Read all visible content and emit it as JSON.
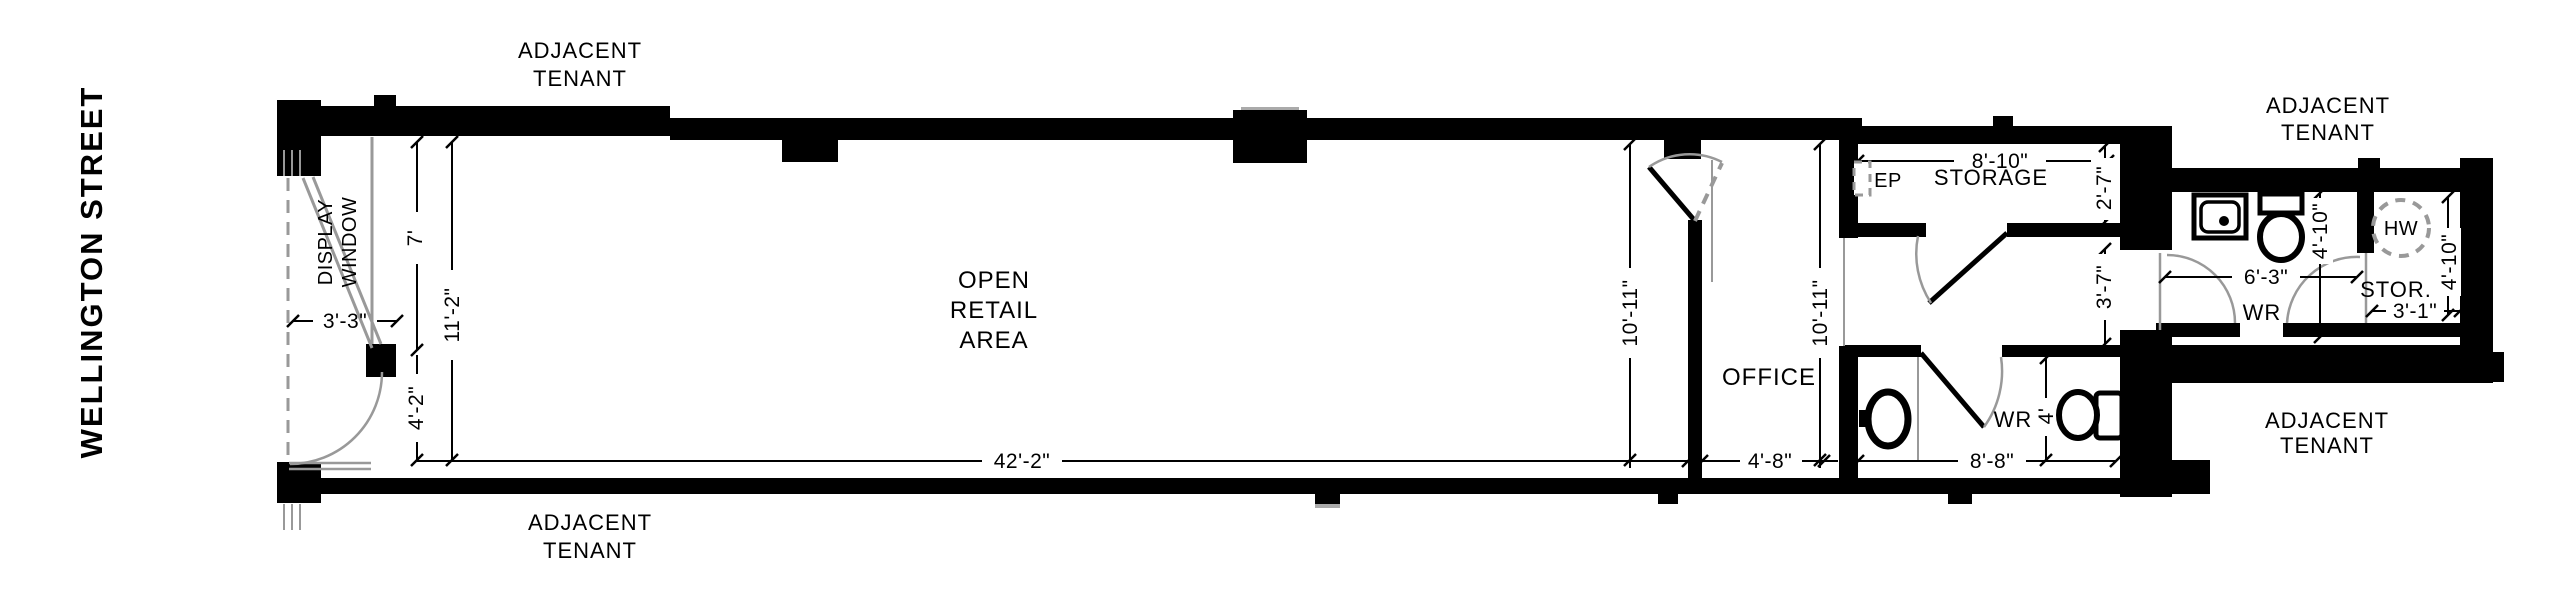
{
  "street_label": "WELLINGTON STREET",
  "adjacent_tenant": {
    "line1": "ADJACENT",
    "line2": "TENANT"
  },
  "rooms": {
    "open_retail_1": "OPEN",
    "open_retail_2": "RETAIL",
    "open_retail_3": "AREA",
    "display_window_1": "DISPLAY",
    "display_window_2": "WINDOW",
    "office": "OFFICE",
    "storage": "STORAGE",
    "washroom": "WR",
    "washroom_upper": "WR",
    "storage_upper": "STOR.",
    "hot_water_tank": "HW",
    "electrical_panel": "EP"
  },
  "dimensions": {
    "display_window_width": "3'-3\"",
    "display_window_depth": "7'",
    "storefront_depth_total": "11'-2\"",
    "entry_depth": "4'-2\"",
    "retail_length": "42'-2\"",
    "retail_depth": "10'-11\"",
    "office_depth": "10'-11\"",
    "office_width": "4'-8\"",
    "storage_width": "8'-10\"",
    "storage_depth": "2'-7\"",
    "hall_depth": "3'-7\"",
    "washroom_width": "8'-8\"",
    "washroom_depth": "4'",
    "washroom_upper_width": "6'-3\"",
    "washroom_upper_depth": "4'-10\"",
    "storage_upper_width": "3'-1\"",
    "storage_upper_depth": "4'-10\""
  },
  "colors": {
    "wall": "#000000",
    "secondary": "#999999",
    "background": "#ffffff"
  }
}
